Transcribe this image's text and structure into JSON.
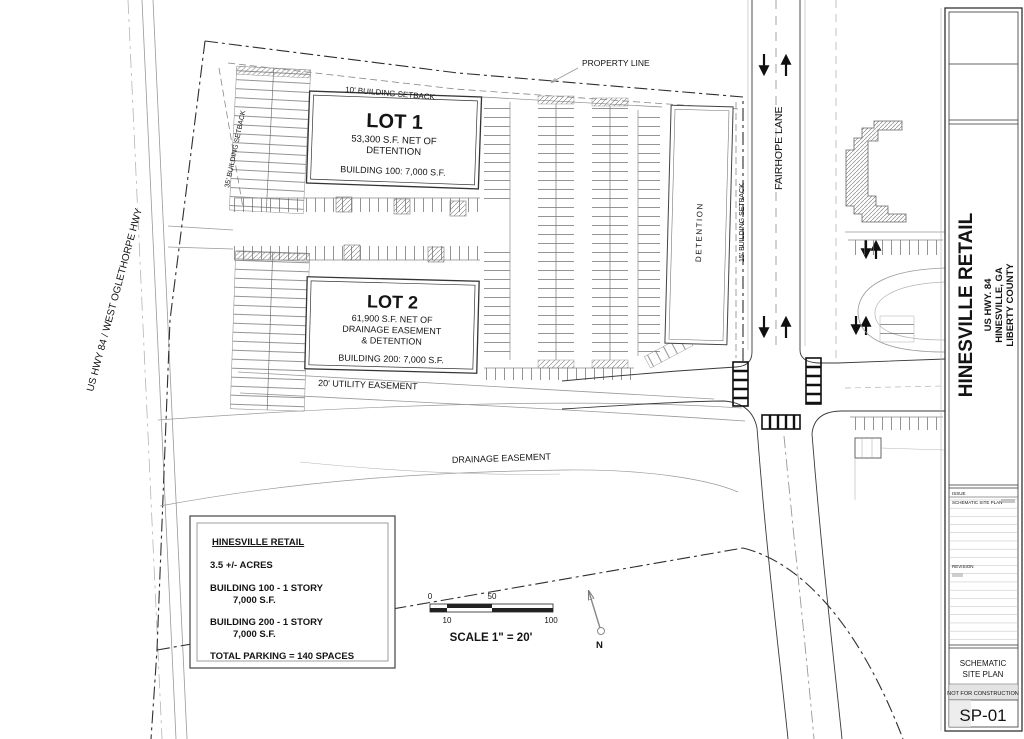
{
  "colors": {
    "line": "#3a3a3a",
    "light_line": "#999999",
    "text": "#141414",
    "paper": "#ffffff",
    "crosswalk": "#111111"
  },
  "plan": {
    "lot1": {
      "title": "LOT 1",
      "area_line1": "53,300 S.F. NET OF",
      "area_line2": "DETENTION",
      "building": "BUILDING 100: 7,000 S.F."
    },
    "lot2": {
      "title": "LOT 2",
      "area_line1": "61,900 S.F. NET OF",
      "area_line2": "DRAINAGE EASEMENT",
      "area_line3": "& DETENTION",
      "building": "BUILDING 200: 7,000 S.F."
    },
    "labels": {
      "property_line": "PROPERTY LINE",
      "setback_10": "10' BUILDING SETBACK",
      "setback_35": "35' BUILDING SETBACK",
      "setback_15": "15' BUILDING SETBACK",
      "detention": "DETENTION",
      "utility_easement": "20' UTILITY EASEMENT",
      "drainage_easement": "DRAINAGE EASEMENT",
      "fairhope_lane": "FAIRHOPE LANE",
      "us_hwy": "US HWY 84 / WEST OGLETHORPE HWY",
      "north": "N"
    },
    "scale_bar": {
      "tick_0": "0",
      "tick_10": "10",
      "tick_50": "50",
      "tick_100": "100",
      "caption": "SCALE 1\" = 20'"
    },
    "summary": {
      "title": "HINESVILLE RETAIL",
      "acres": "3.5 +/- ACRES",
      "building100_line1": "BUILDING 100 - 1 STORY",
      "building100_line2": "7,000 S.F.",
      "building200_line1": "BUILDING 200 - 1 STORY",
      "building200_line2": "7,000 S.F.",
      "total_parking": "TOTAL PARKING = 140 SPACES"
    }
  },
  "titleblock": {
    "project": "HINESVILLE RETAIL",
    "address1": "US HWY. 84",
    "address2": "HINESVILLE, GA",
    "address3": "LIBERTY COUNTY",
    "issue_label": "ISSUE",
    "issue_entry": "SCHEMATIC SITE PLAN",
    "revision_label": "REVISION",
    "sheet_type_line1": "SCHEMATIC",
    "sheet_type_line2": "SITE PLAN",
    "disclaimer": "NOT FOR CONSTRUCTION",
    "sheet_number": "SP-01"
  }
}
